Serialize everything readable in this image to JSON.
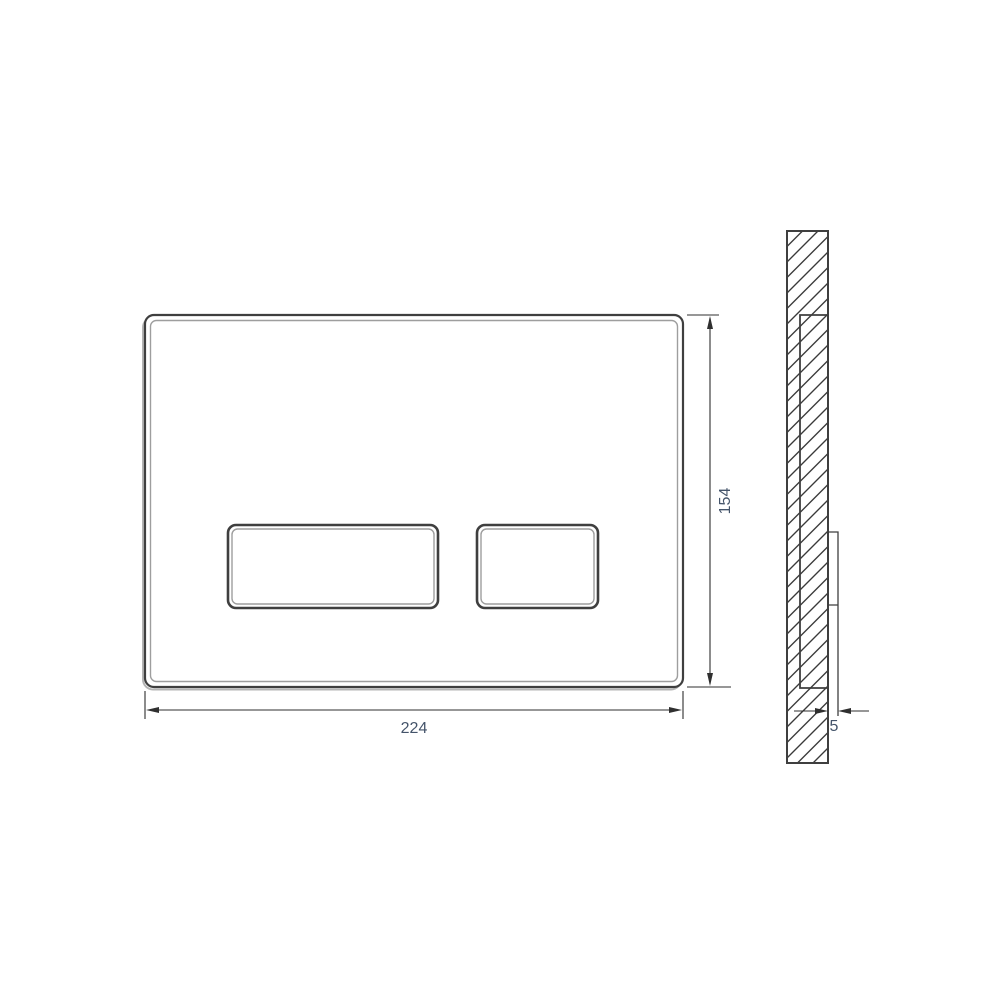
{
  "drawing": {
    "dimensions": {
      "width": {
        "value": "224"
      },
      "height": {
        "value": "154"
      },
      "thickness": {
        "value": "5"
      }
    },
    "colors": {
      "outline": "#3f3f3f",
      "bevel_edge": "#9e9e9e",
      "dimension_line": "#2f2f2f",
      "dimension_text": "#44546a",
      "background": "#ffffff"
    }
  }
}
